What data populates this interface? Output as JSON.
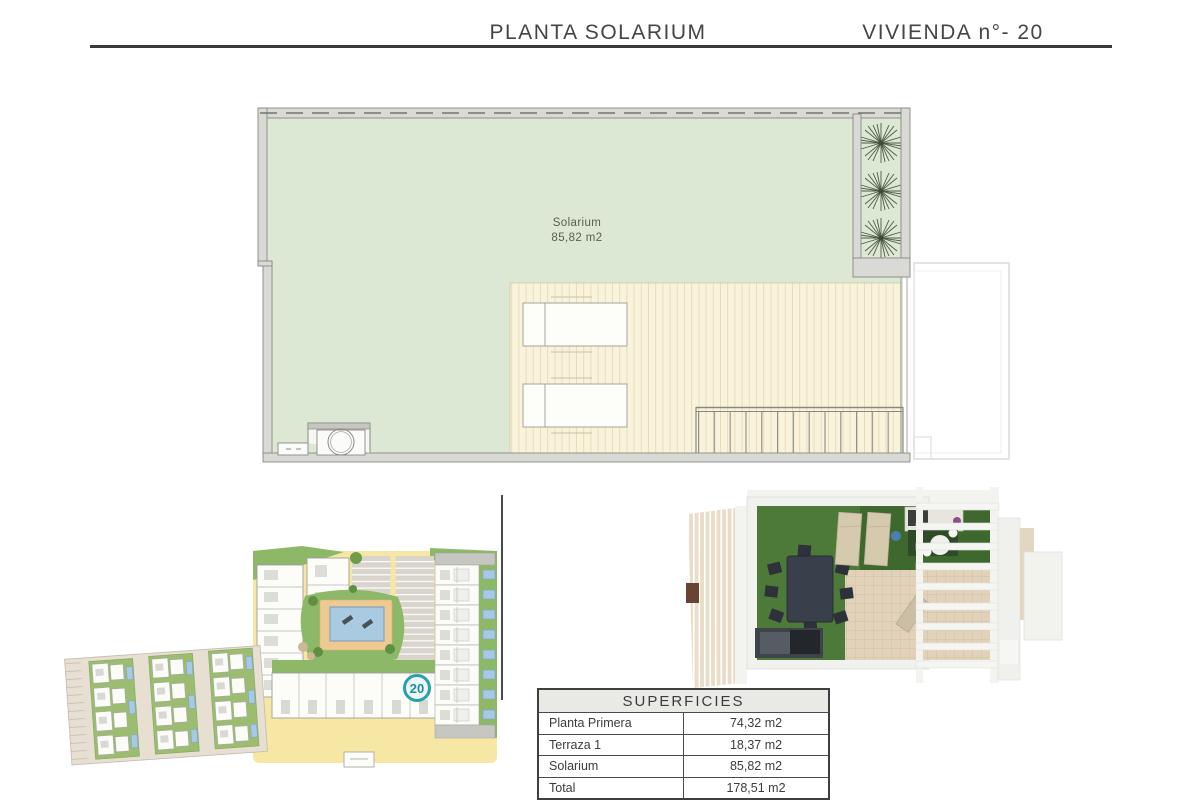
{
  "header": {
    "plan_title": "PLANTA SOLARIUM",
    "unit_title": "VIVIENDA n°- 20"
  },
  "floor_plan": {
    "room_label": "Solarium",
    "room_area": "85,82 m2"
  },
  "site_plan": {
    "unit_marker": "20"
  },
  "surfaces_table": {
    "title": "SUPERFICIES",
    "rows": [
      {
        "label": "Planta Primera",
        "value": "74,32 m2"
      },
      {
        "label": "Terraza 1",
        "value": "18,37 m2"
      },
      {
        "label": "Solarium",
        "value": "85,82 m2"
      },
      {
        "label": "Total",
        "value": "178,51 m2"
      }
    ]
  },
  "colors": {
    "accent_teal": "#2ba0ad",
    "plan_green": "#dce8d4",
    "deck_cream": "#faf3dc",
    "wall_gray": "#d9d9d6",
    "site_yellow": "#f6e7a4",
    "site_green": "#8cb868",
    "pool_blue": "#a9cbe2",
    "render_grass": "#4e7a39",
    "header_text": "#454545"
  }
}
